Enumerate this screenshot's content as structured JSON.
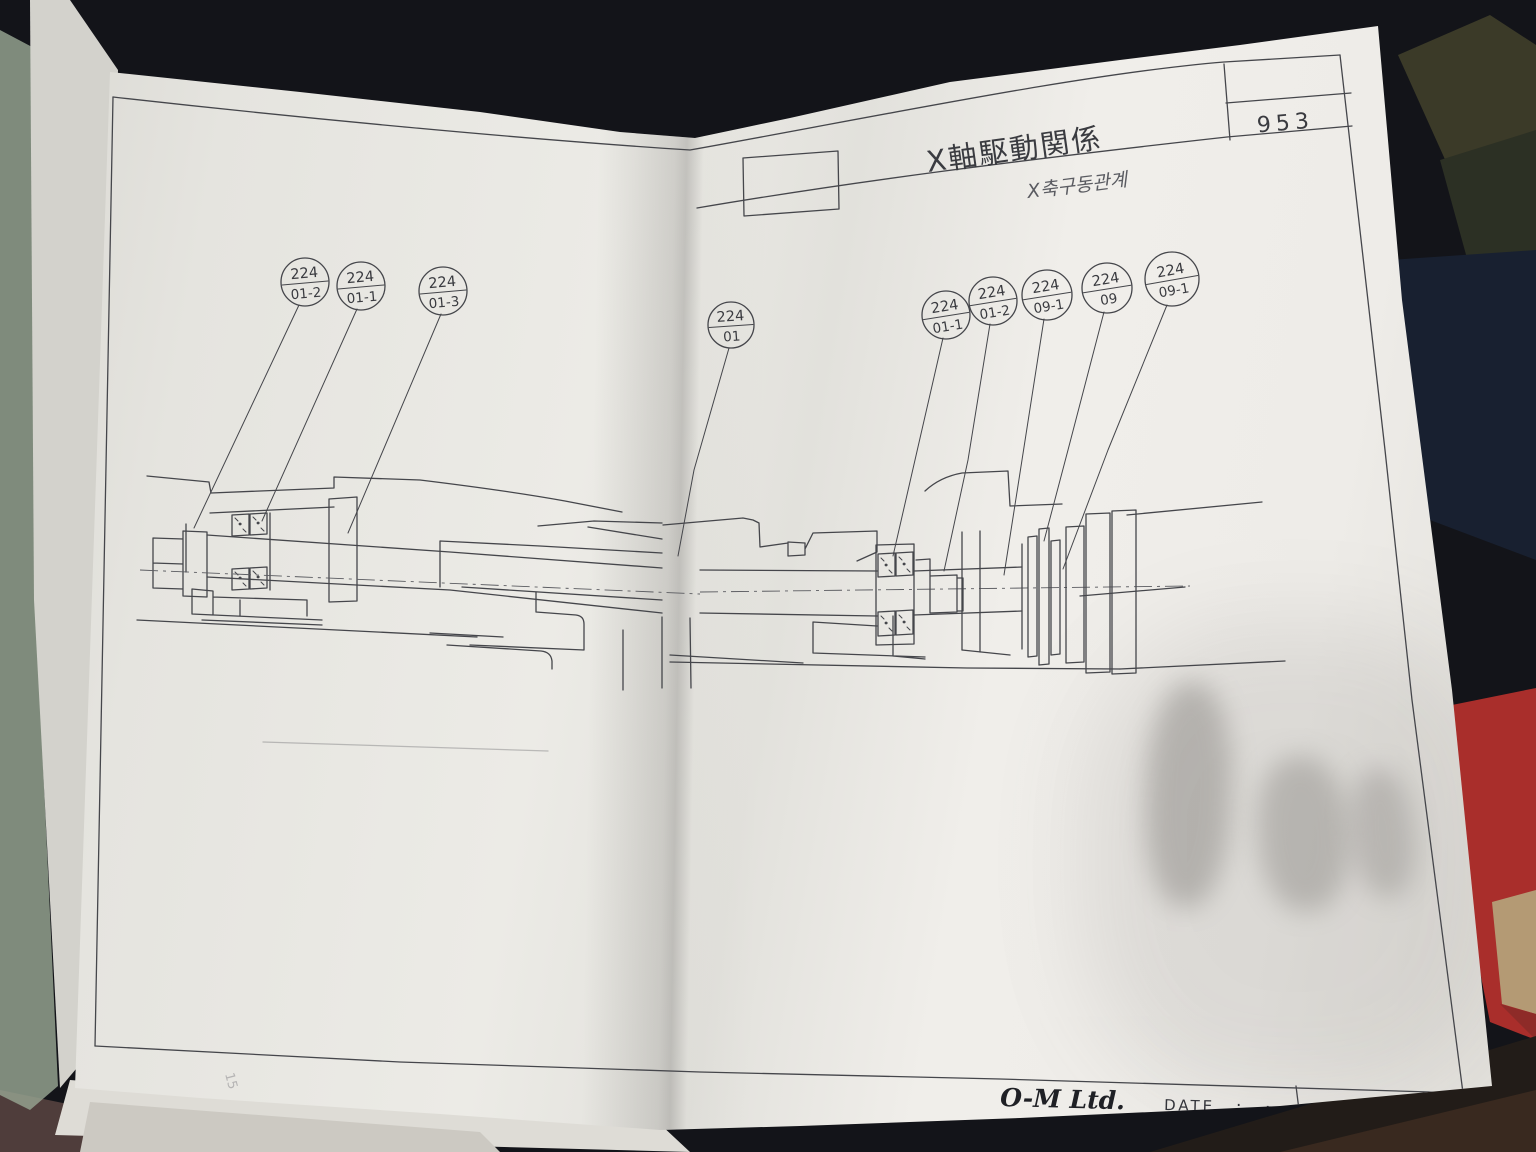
{
  "page": {
    "title": "X軸駆動関係",
    "page_number": "953",
    "handwritten_annotation": "X축구동관계",
    "margin_pencil_mark": "15"
  },
  "footer": {
    "company": "O-M Ltd.",
    "date_label": "DATE",
    "date_dots": [
      ".",
      "."
    ]
  },
  "balloons": [
    {
      "group": "left",
      "code": "224",
      "item": "01-2"
    },
    {
      "group": "left",
      "code": "224",
      "item": "01-1"
    },
    {
      "group": "left",
      "code": "224",
      "item": "01-3"
    },
    {
      "group": "middle",
      "code": "224",
      "item": "01"
    },
    {
      "group": "right",
      "code": "224",
      "item": "01-1"
    },
    {
      "group": "right",
      "code": "224",
      "item": "01-2"
    },
    {
      "group": "right",
      "code": "224",
      "item": "09-1"
    },
    {
      "group": "right",
      "code": "224",
      "item": "09"
    },
    {
      "group": "right",
      "code": "224",
      "item": "09-1"
    }
  ],
  "colors": {
    "paper": "#eceae5",
    "ink": "#45464b",
    "background": "#131419",
    "desk_brown": "#4f3d3b",
    "fabric_red": "#a92e2b",
    "fabric_tan": "#b49a74",
    "book_cover_green": "#93a08e"
  }
}
